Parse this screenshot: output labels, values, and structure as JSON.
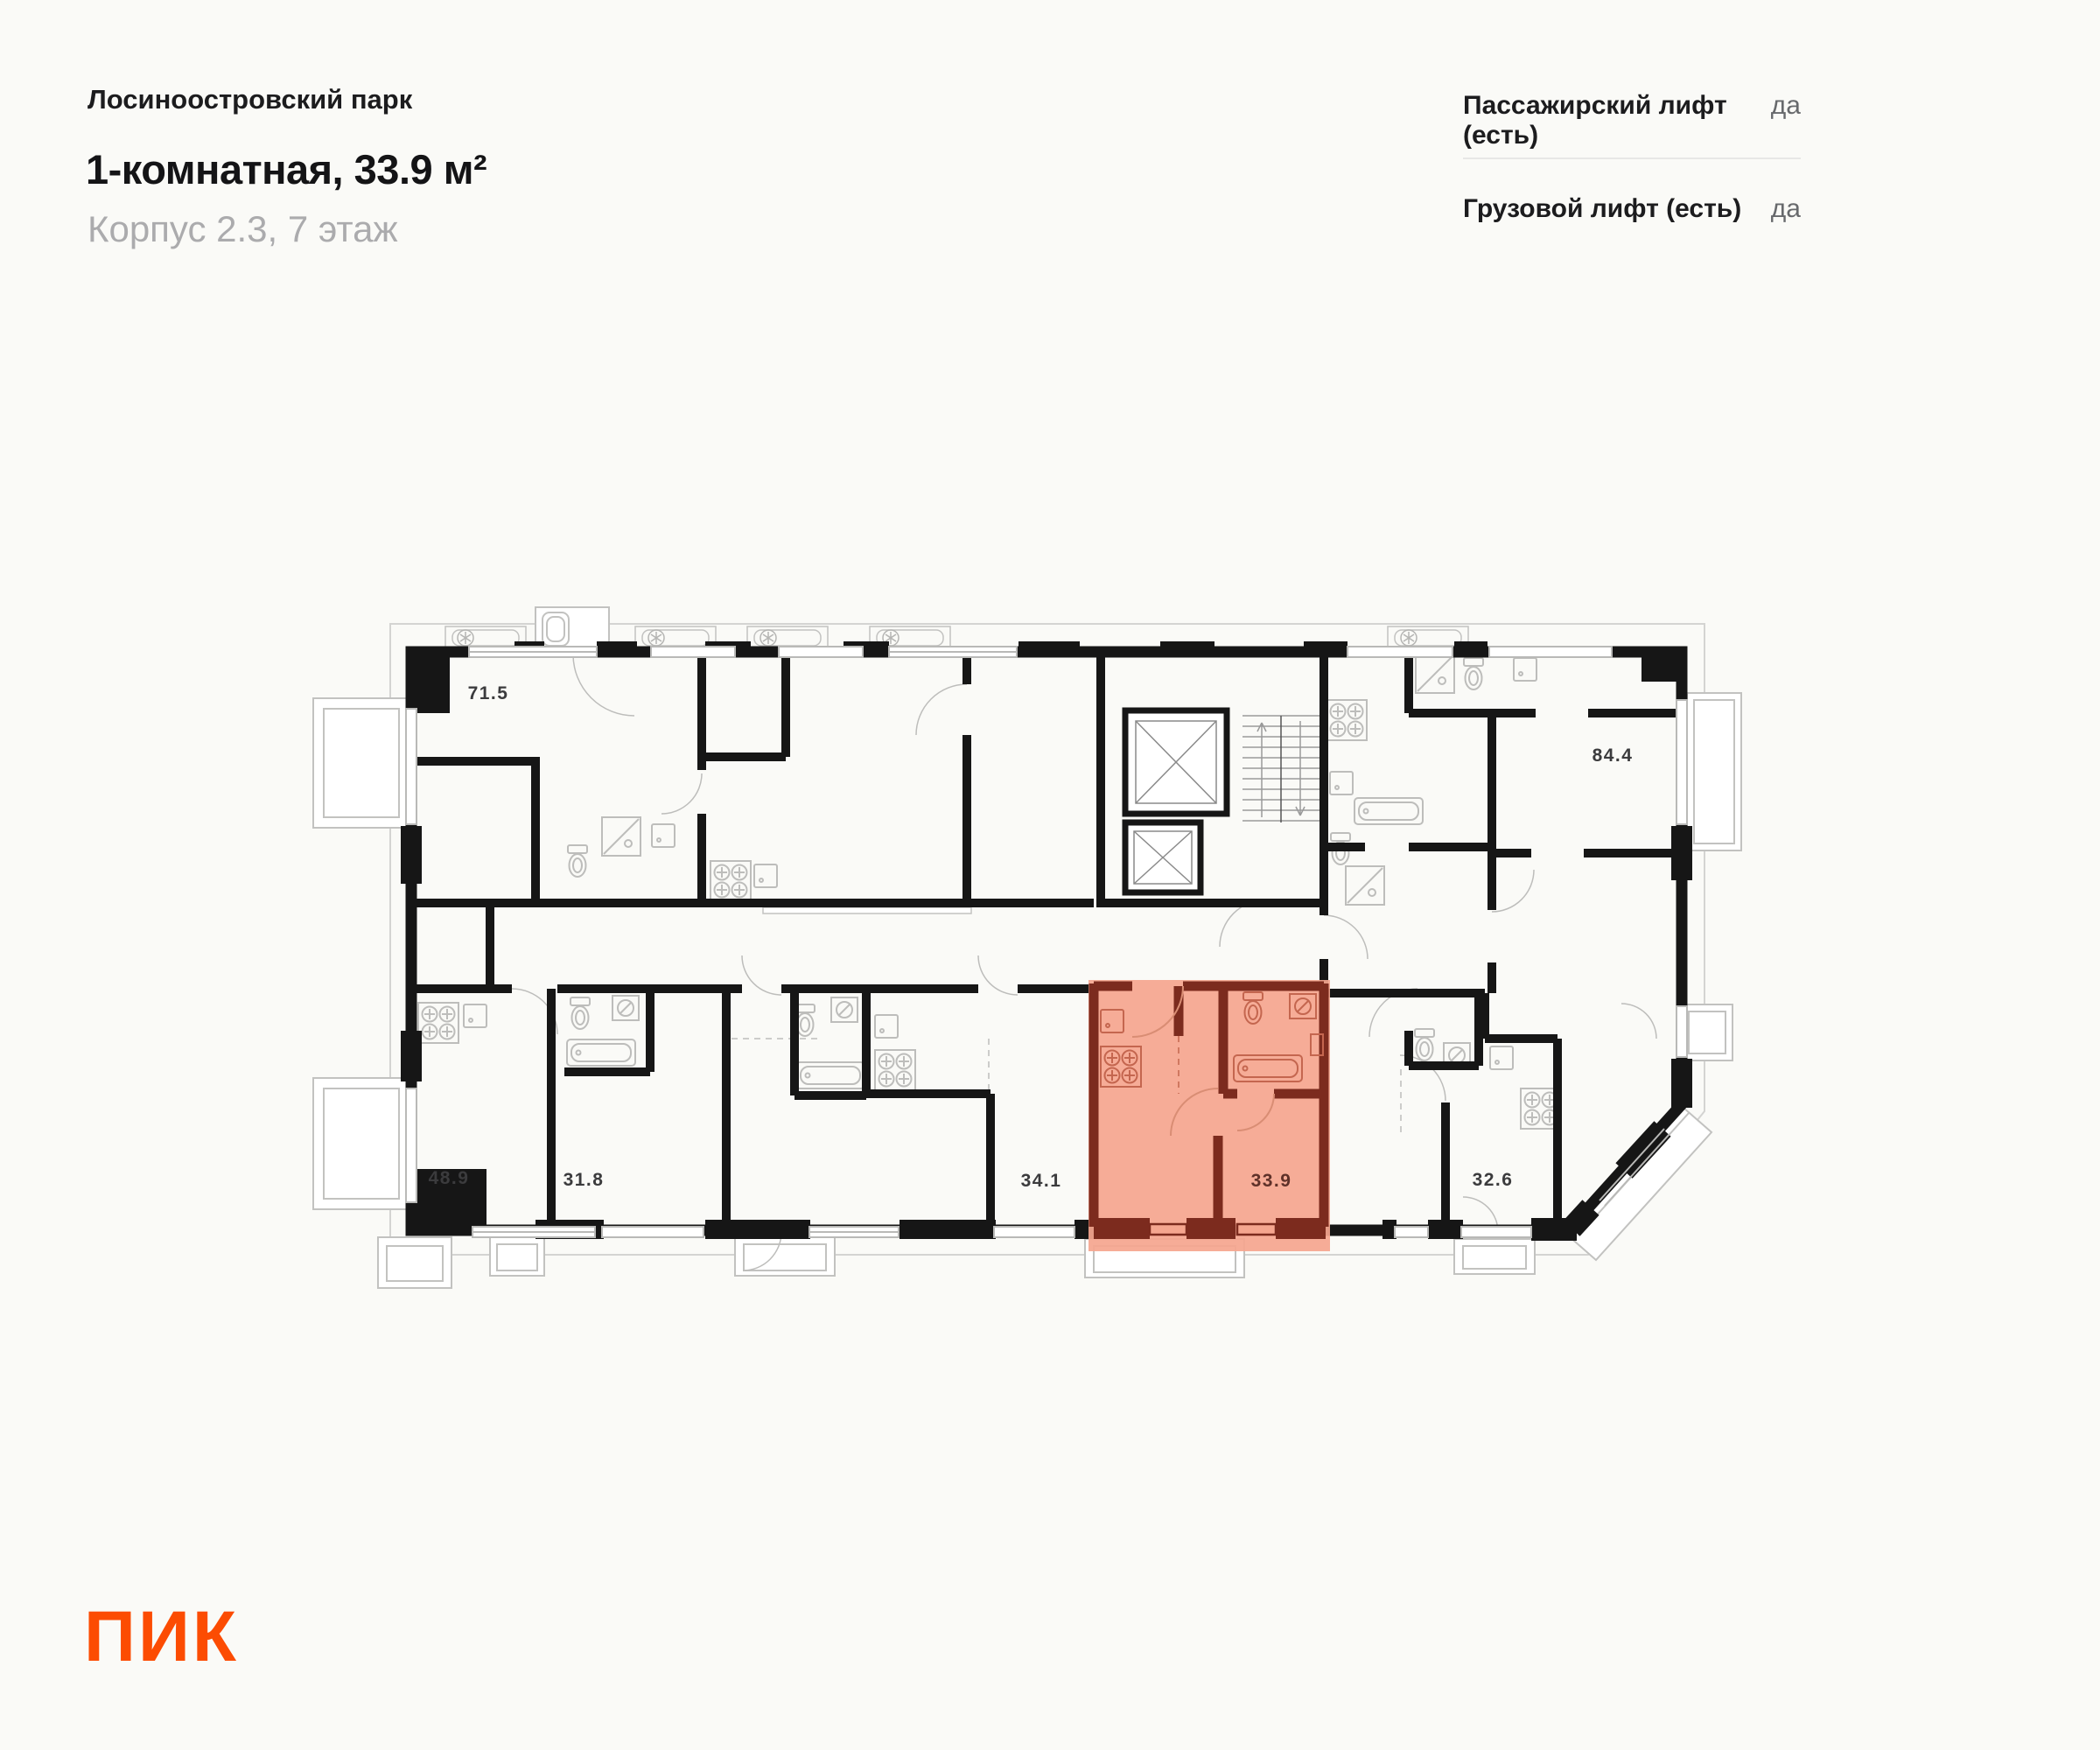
{
  "header": {
    "project_name": "Лосиноостровский парк",
    "apartment_title": "1-комнатная, 33.9 м²",
    "apartment_subtitle": "Корпус 2.3, 7 этаж"
  },
  "elevator_info": {
    "rows": [
      {
        "label": "Пассажирский лифт (есть)",
        "value": "да"
      },
      {
        "label": "Грузовой лифт (есть)",
        "value": "да"
      }
    ]
  },
  "floorplan": {
    "highlighted_unit": {
      "area": "33.9",
      "fill_color": "#f5a68f",
      "wall_color": "#7c2b1e"
    },
    "units": [
      {
        "area": "71.5"
      },
      {
        "area": "48.9"
      },
      {
        "area": "31.8"
      },
      {
        "area": "34.1"
      },
      {
        "area": "32.6"
      },
      {
        "area": "84.4"
      }
    ]
  },
  "footer": {
    "logo_text": "ПИК",
    "logo_color": "#fc4c02"
  }
}
